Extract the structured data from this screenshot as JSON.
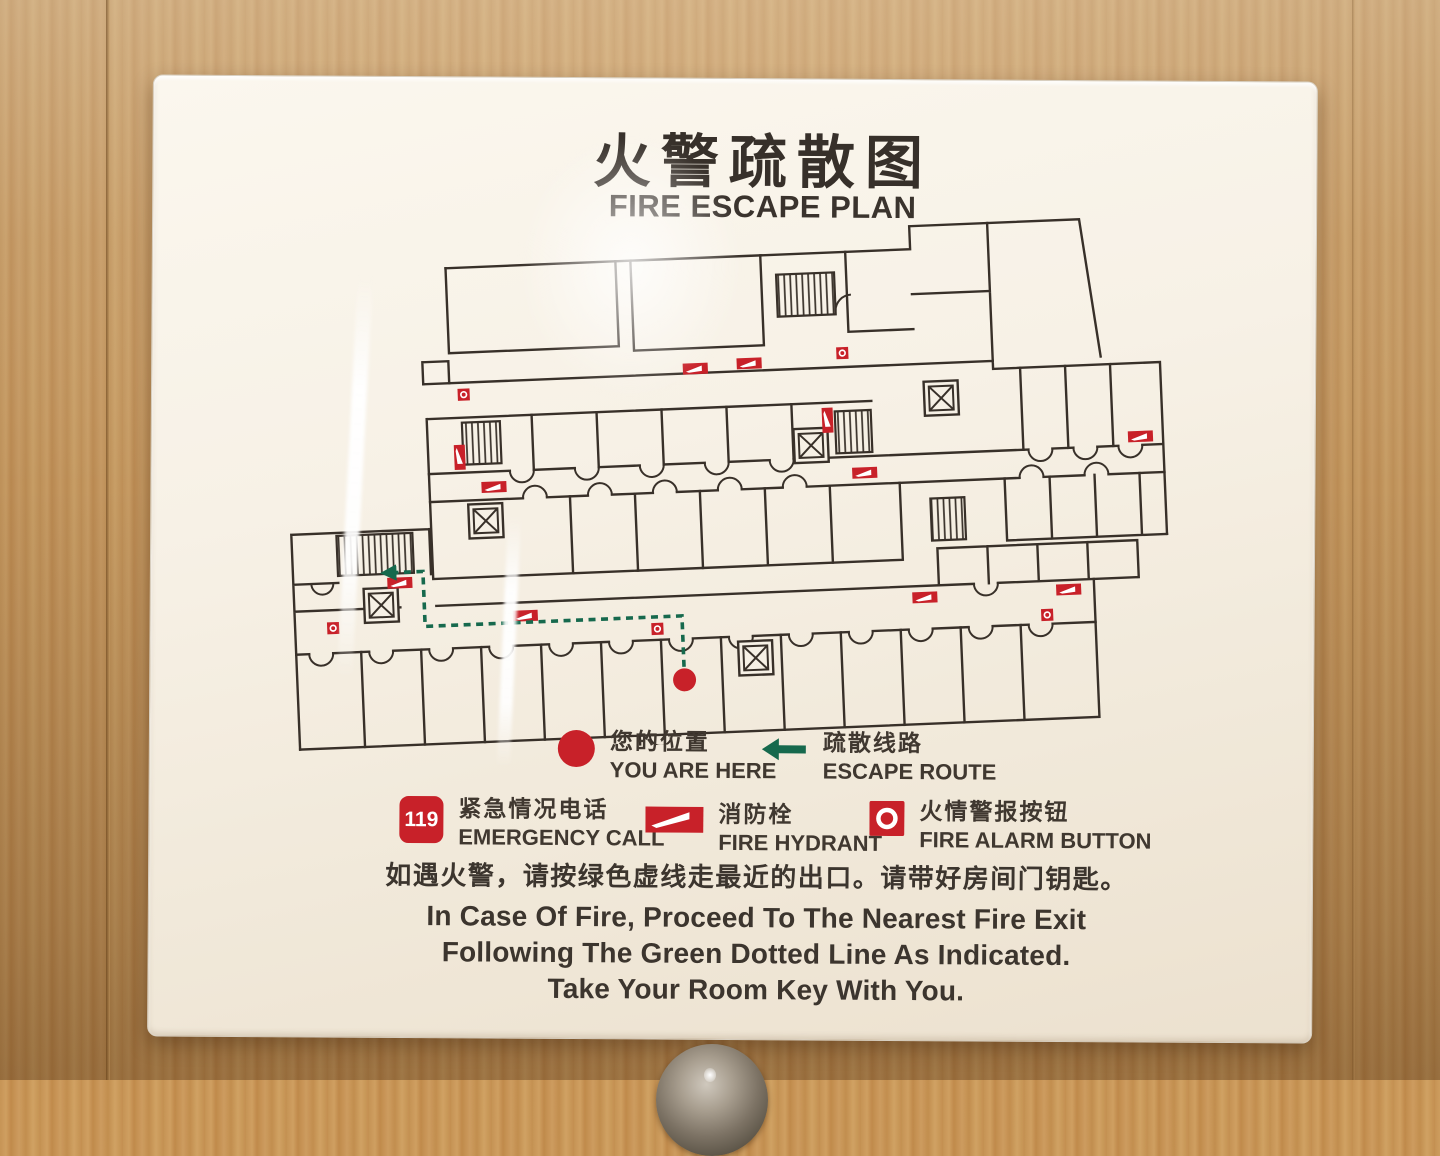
{
  "sign": {
    "title_zh": "火警疏散图",
    "title_en": "FIRE ESCAPE PLAN",
    "legend": {
      "you_are_here": {
        "icon": "you-are-here-dot-icon",
        "zh": "您的位置",
        "en": "YOU ARE HERE"
      },
      "escape_route": {
        "icon": "escape-route-arrow-icon",
        "zh": "疏散线路",
        "en": "ESCAPE ROUTE"
      },
      "emergency_call": {
        "icon": "emergency-call-119-icon",
        "badge": "119",
        "zh": "紧急情况电话",
        "en": "EMERGENCY CALL"
      },
      "fire_hydrant": {
        "icon": "fire-hydrant-icon",
        "zh": "消防栓",
        "en": "FIRE HYDRANT"
      },
      "fire_alarm": {
        "icon": "fire-alarm-button-icon",
        "zh": "火情警报按钮",
        "en": "FIRE ALARM BUTTON"
      }
    },
    "instructions": {
      "zh": "如遇火警，请按绿色虚线走最近的出口。请带好房间门钥匙。",
      "en_line1": "In Case Of Fire, Proceed To The Nearest Fire Exit",
      "en_line2": "Following The Green Dotted Line As Indicated.",
      "en_line3": "Take Your Room Key With You."
    },
    "colors": {
      "marker_red": "#c82129",
      "route_green": "#16694d",
      "wall_line": "#383029",
      "sign_background": "#f6f0e5",
      "wood": "#c69455"
    }
  }
}
